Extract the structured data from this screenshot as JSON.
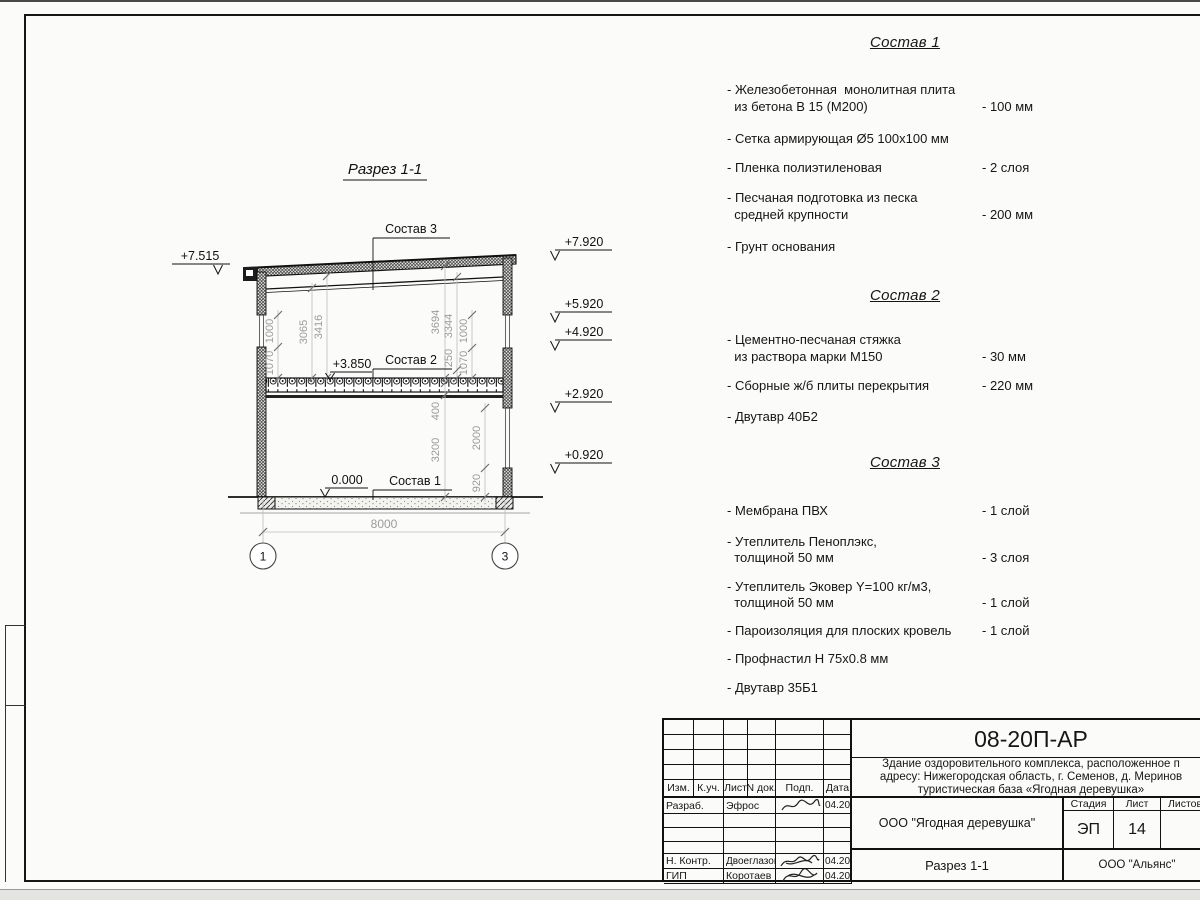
{
  "drawing": {
    "title": "Разрез 1-1",
    "axis_left": "1",
    "axis_right": "3",
    "callout1": "Состав 1",
    "callout2": "Состав 2",
    "callout3": "Состав 3",
    "elev": {
      "roof_left": "+7.515",
      "floor2": "+3.850",
      "zero": "0.000",
      "r0": "+7.920",
      "r1": "+5.920",
      "r2": "+4.920",
      "r3": "+2.920",
      "r4": "+0.920"
    },
    "dim": {
      "span": "8000",
      "l_1000": "1000",
      "l_1070": "1070",
      "h_3065": "3065",
      "h_3416": "3416",
      "r_3694": "3694",
      "r_3344": "3344",
      "r_250": "250",
      "r_1000": "1000",
      "r_1070": "1070",
      "g_400": "400",
      "g_3200": "3200",
      "g_2000": "2000",
      "g_920": "920"
    }
  },
  "specs": [
    {
      "title": "Состав 1",
      "items": [
        {
          "name": "- Железобетонная  монолитная плита\n  из бетона В 15 (М200)",
          "value": "- 100 мм"
        },
        {
          "name": "- Сетка армирующая Ø5 100х100 мм",
          "value": ""
        },
        {
          "name": "- Пленка полиэтиленовая",
          "value": "-  2 слоя"
        },
        {
          "name": "- Песчаная подготовка из песка\n  средней крупности",
          "value": "- 200 мм"
        },
        {
          "name": "- Грунт основания",
          "value": ""
        }
      ]
    },
    {
      "title": "Состав 2",
      "items": [
        {
          "name": "- Цементно-песчаная стяжка\n  из раствора марки М150",
          "value": "- 30 мм"
        },
        {
          "name": "- Сборные ж/б плиты перекрытия",
          "value": "- 220 мм"
        },
        {
          "name": "- Двутавр 40Б2",
          "value": ""
        }
      ]
    },
    {
      "title": "Состав 3",
      "items": [
        {
          "name": "- Мембрана ПВХ",
          "value": "- 1 слой"
        },
        {
          "name": "- Утеплитель Пеноплэкс,\n  толщиной 50 мм",
          "value": "- 3 слоя"
        },
        {
          "name": "- Утеплитель Эковер Y=100 кг/м3,\n  толщиной 50 мм",
          "value": "- 1 слой"
        },
        {
          "name": "- Пароизоляция для плоских кровель",
          "value": "- 1 слой"
        },
        {
          "name": "- Профнастил Н 75х0.8 мм",
          "value": ""
        },
        {
          "name": "- Двутавр 35Б1",
          "value": ""
        }
      ]
    }
  ],
  "titleblock": {
    "doc_number": "08-20П-АР",
    "project_line1": "Здание оздоровительного комплекса, расположенное п",
    "project_line2": "адресу: Нижегородская область, г. Семенов, д. Меринов",
    "project_line3": "туристическая база «Ягодная деревушка»",
    "cols": {
      "izm": "Изм.",
      "kuch": "К.уч.",
      "list": "Лист",
      "ndok": "N док.",
      "podp": "Подп.",
      "data": "Дата"
    },
    "row_razrab": {
      "role": "Разраб.",
      "name": "Эфрос",
      "date": "04.20"
    },
    "row_nkontr": {
      "role": "Н. Контр.",
      "name": "Двоеглазов",
      "date": "04.20"
    },
    "row_gip": {
      "role": "ГИП",
      "name": "Коротаев",
      "date": "04.20"
    },
    "company": "ООО \"Ягодная деревушка\"",
    "stage_label": "Стадия",
    "sheet_label": "Лист",
    "sheets_label": "Листов",
    "stage": "ЭП",
    "sheet_num": "14",
    "section_name": "Разрез 1-1",
    "contractor": "ООО \"Альянс\""
  }
}
